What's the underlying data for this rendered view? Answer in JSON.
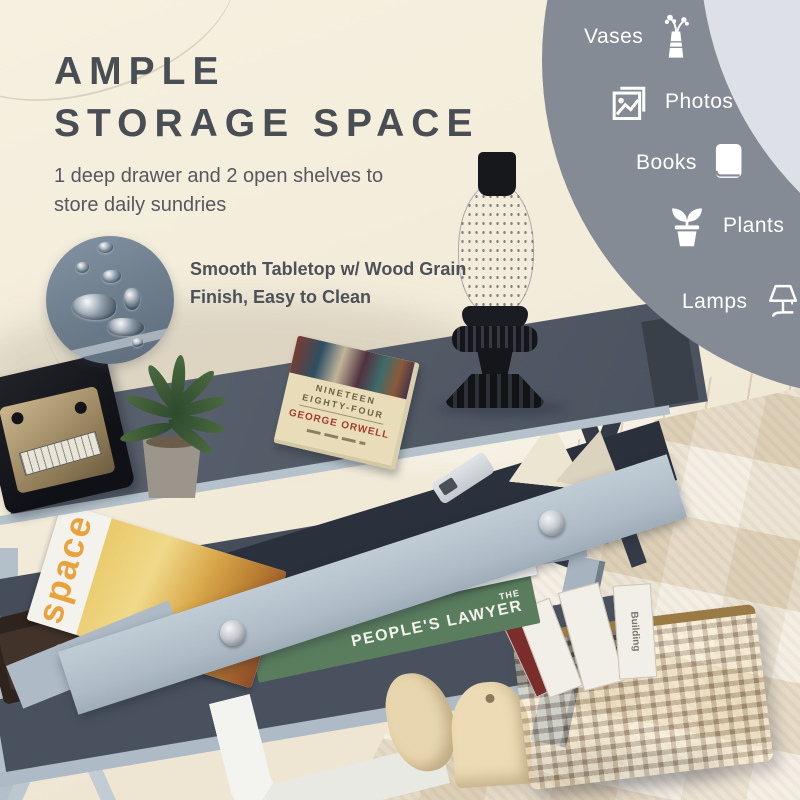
{
  "headline": {
    "line1": "AMPLE",
    "line2": "STORAGE SPACE"
  },
  "subheadline": {
    "line1": "1 deep drawer and 2 open shelves to",
    "line2": "store daily sundries"
  },
  "callout": {
    "line1": "Smooth Tabletop w/ Wood Grain",
    "line2": "Finish, Easy to Clean"
  },
  "storage_items": [
    {
      "label": "Vases",
      "icon": "vase-icon"
    },
    {
      "label": "Photos",
      "icon": "photos-icon"
    },
    {
      "label": "Books",
      "icon": "book-icon"
    },
    {
      "label": "Plants",
      "icon": "plant-icon"
    },
    {
      "label": "Lamps",
      "icon": "lamp-icon"
    }
  ],
  "scene": {
    "book_on_table": {
      "title_line1": "NINETEEN",
      "title_line2": "EIGHTY-FOUR",
      "author": "GEORGE ORWELL"
    },
    "shelf_books": {
      "top_spine": "ROCKY",
      "bottom_spine_small": "THE",
      "bottom_spine": "PEOPLE'S LAWYER"
    },
    "drawer_magazine_spine": "space",
    "basket_magazine_spine": "Building"
  },
  "colors": {
    "headline_text": "#494e55",
    "body_text": "#55595f",
    "panel_circle": "#858b95",
    "panel_crescent": "#dde1e7",
    "panel_text": "#ffffff",
    "tabletop": "#525a66",
    "drawer_front": "#b6c3cd",
    "couch": "#f1ead9",
    "carpet": "#e6dac5"
  }
}
